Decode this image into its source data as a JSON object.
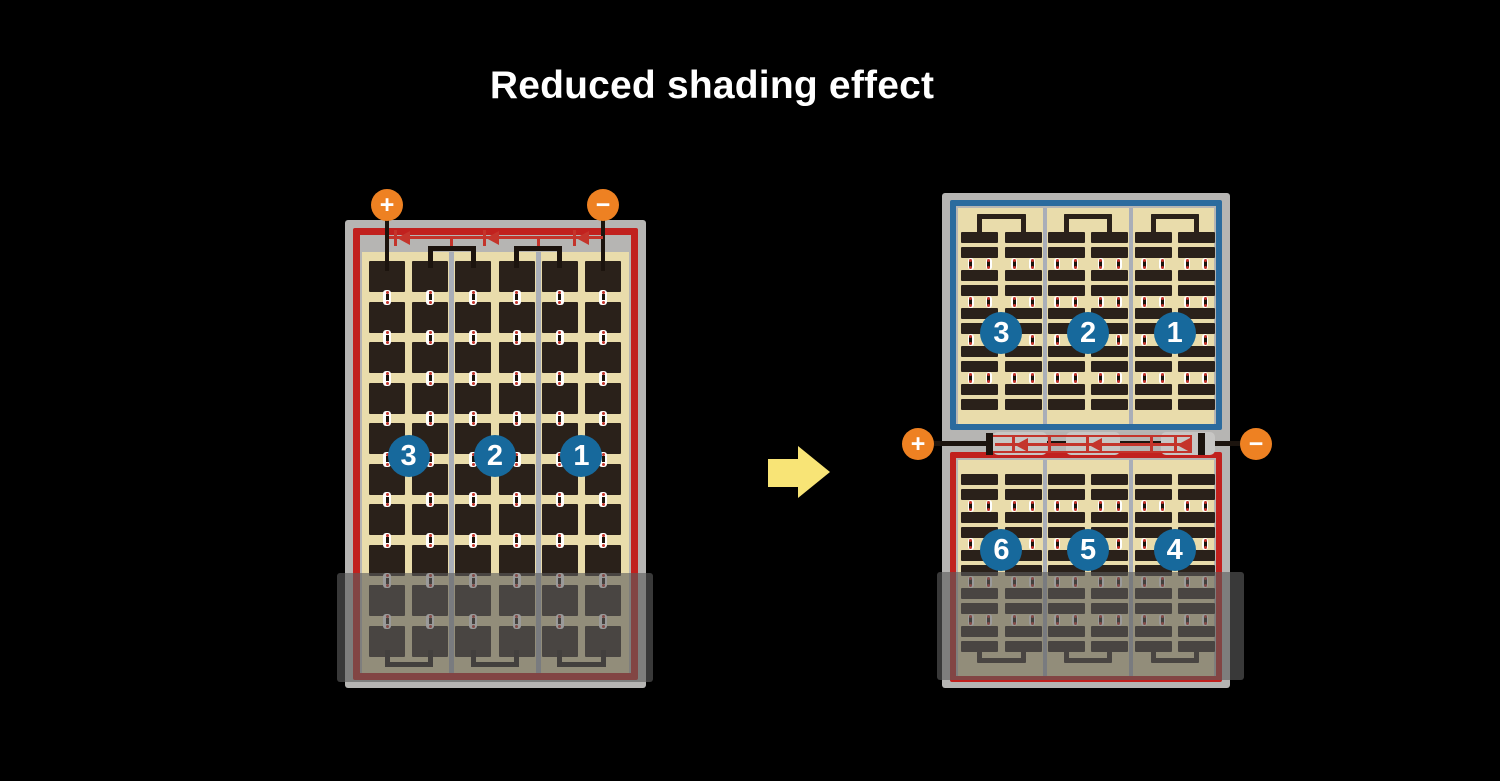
{
  "title": "Reduced shading effect",
  "colors": {
    "background": "#000000",
    "title_text": "#ffffff",
    "frame_gray": "#b6b5b3",
    "panel_red": "#c1211e",
    "panel_blue": "#2b6b9e",
    "cell_field_tan": "#e9dcab",
    "cell_dark": "#2a211a",
    "string_divider": "#a9aeb8",
    "terminal_orange": "#ee8122",
    "badge_blue": "#17699c",
    "arrow_yellow": "#f8e476",
    "wire_black": "#1c140e",
    "diode_red": "#c4342b",
    "junction_gray": "#c7c6c4",
    "connector_white": "#ffffff",
    "shade_overlay": "rgba(92,92,92,0.62)"
  },
  "left_module": {
    "grid": {
      "columns": 6,
      "rows": 10,
      "strings": 3
    },
    "terminals": {
      "positive": "+",
      "negative": "−"
    },
    "string_badges": [
      "3",
      "2",
      "1"
    ],
    "bypass_diodes": 3,
    "shaded": true
  },
  "right_module": {
    "terminals": {
      "positive": "+",
      "negative": "−"
    },
    "halves": [
      {
        "position": "top",
        "border": "blue",
        "string_badges": [
          "3",
          "2",
          "1"
        ],
        "grid": {
          "columns": 6,
          "rows": 10,
          "strings": 3
        }
      },
      {
        "position": "bottom",
        "border": "red",
        "string_badges": [
          "6",
          "5",
          "4"
        ],
        "grid": {
          "columns": 6,
          "rows": 10,
          "strings": 3
        }
      }
    ],
    "bypass_diodes": 3,
    "shaded": true
  }
}
